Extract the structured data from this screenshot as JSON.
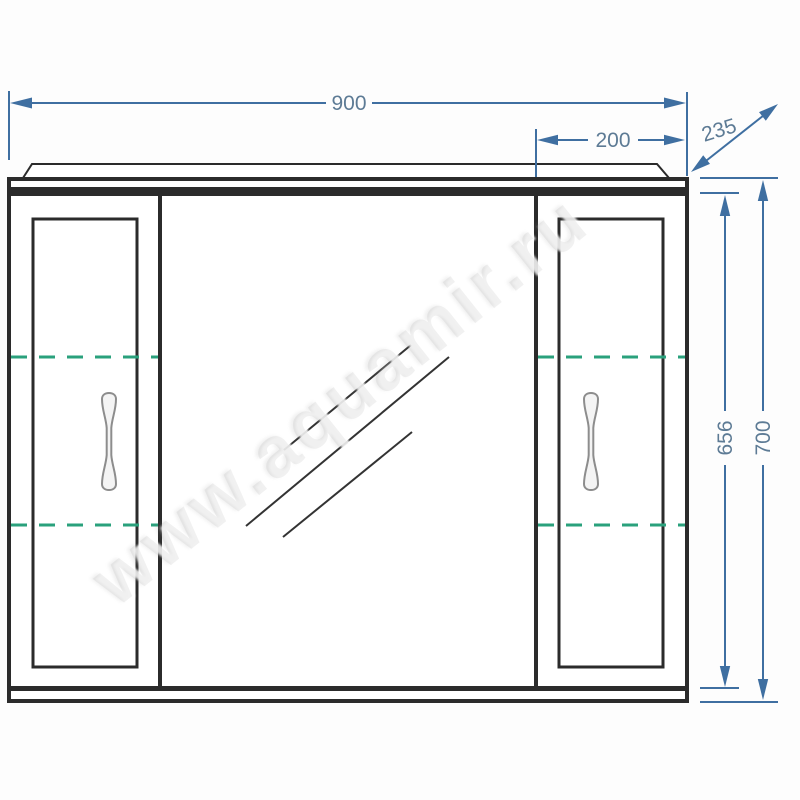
{
  "drawing": {
    "type": "technical-drawing-mirror-cabinet-front-view",
    "watermark": "www.aquamir.ru",
    "dimensions": {
      "total_width_mm": "900",
      "right_door_width_mm": "200",
      "depth_mm": "235",
      "body_height_mm": "656",
      "total_height_mm": "700"
    },
    "colors": {
      "dim": "#3f6fa1",
      "dimtext": "#5d7b95",
      "outline": "#2b2b2b",
      "shelf": "#2aa17c",
      "handle": "#8d8d8d",
      "bg": "#fdfdfd"
    }
  }
}
